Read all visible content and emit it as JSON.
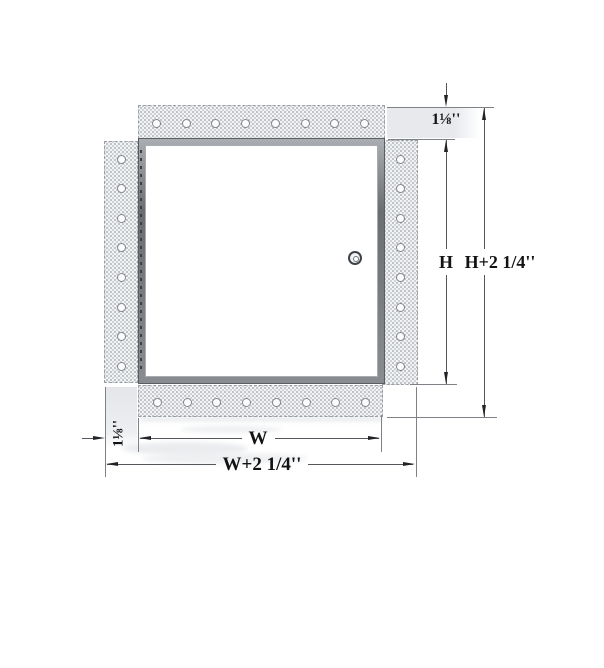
{
  "diagram": {
    "type": "technical-drawing",
    "subject": "recessed access door with drywall bead flange, front elevation",
    "labels": {
      "top_offset": "1⅛''",
      "left_offset": "1⅛''",
      "height": "H",
      "height_overall": "H+2 1/4''",
      "width": "W",
      "width_overall": "W+2 1/4''"
    },
    "flanges": {
      "top_holes": 8,
      "bottom_holes": 8,
      "left_holes": 8,
      "right_holes": 8
    },
    "colors": {
      "flange_fill": "#f2f3f5",
      "stipple": "#9ba0a5",
      "frame_gray": "#898d91",
      "drywall_patch": "#e7e9ec",
      "dimension_line": "#54585c",
      "arrow": "#212326",
      "text": "#121314",
      "background": "#ffffff"
    }
  }
}
